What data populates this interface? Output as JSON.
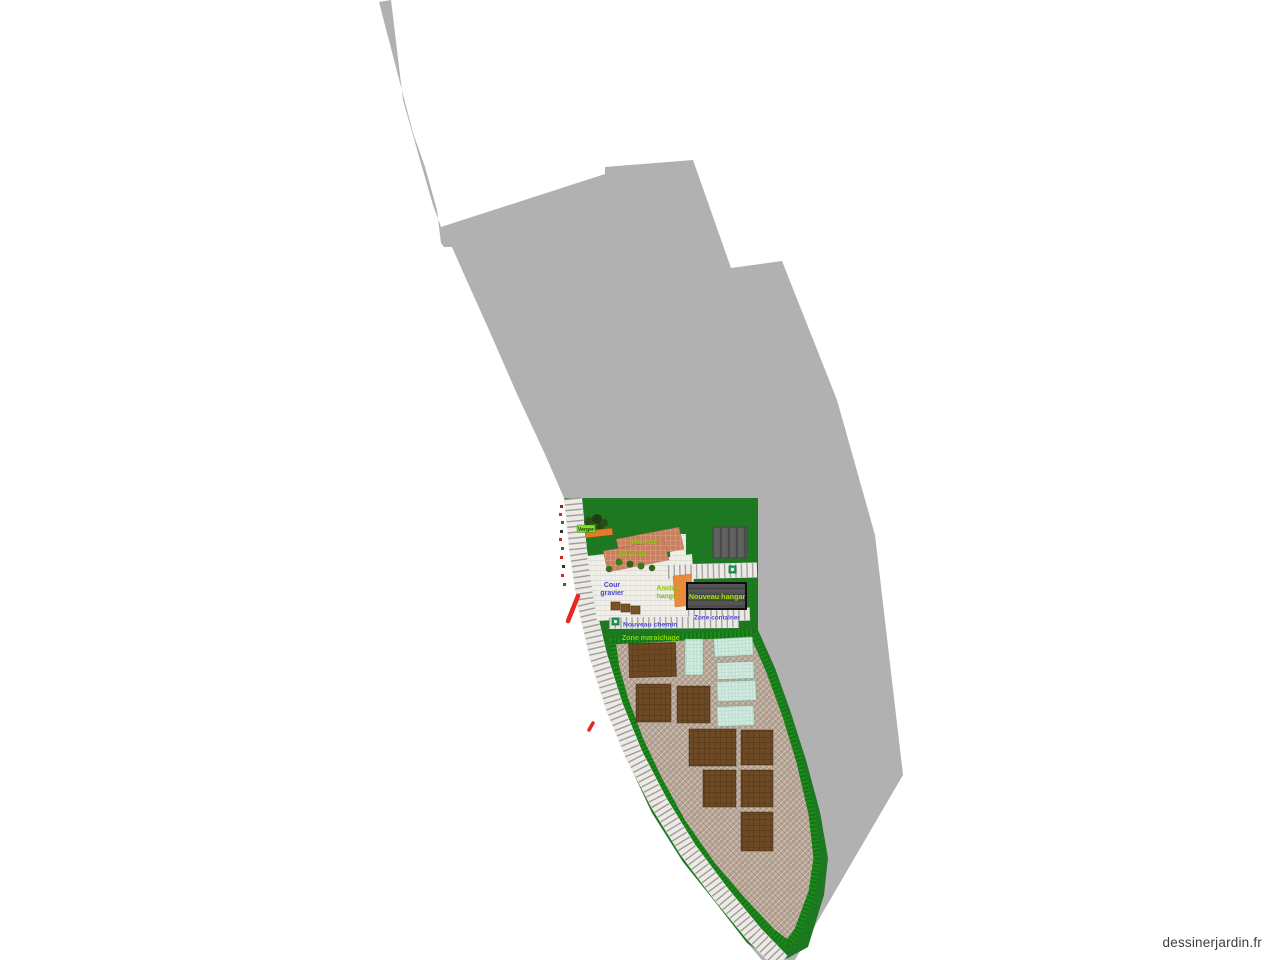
{
  "site": {
    "watermark": "dessinerjardin.fr"
  },
  "plan": {
    "labels": {
      "terrasse_upper": "Terrasse",
      "terrasse_lower": "Terrasse",
      "cour_gravier": {
        "line1": "Cour",
        "line2": "gravier"
      },
      "ancien_hangar": {
        "line1": "Ancien",
        "line2": "hangar"
      },
      "nouveau_hangar": "Nouveau hangar",
      "zone_container": "Zone container",
      "nouveau_chemin": "Nouveau chemin",
      "zone_maraichage": "Zone maraichage",
      "verger": "Verger"
    },
    "colors": {
      "parcel_gray": "#b1b1b1",
      "lawn_green": "#1d7a21",
      "hedge_green": "#1e8a1e",
      "field_beige": "#b5a496",
      "gravel": "#efede9",
      "terrace": "#c8805f",
      "plot_brown": "#6d4a24",
      "plot_mint": "#cfeade",
      "hangar_gray": "#505050",
      "hangar_orange": "#ec8a3c",
      "label_green": "#9de000",
      "label_blue": "#4343cb",
      "mark_red": "#e8281e"
    },
    "counts": {
      "brown_plots": 8,
      "mint_plots": 5
    }
  }
}
